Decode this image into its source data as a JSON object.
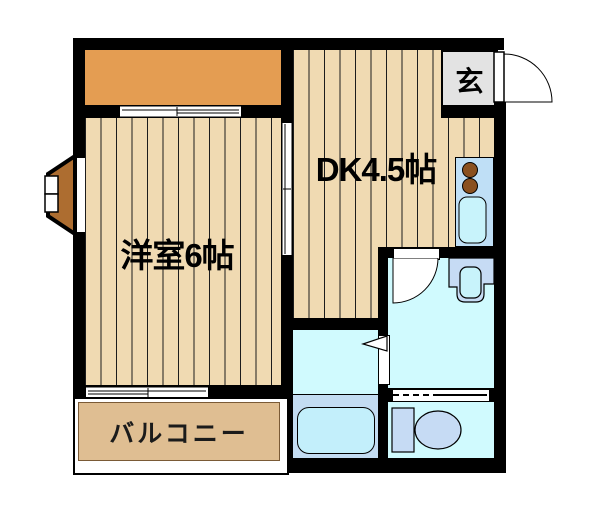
{
  "floorplan": {
    "labels": {
      "dining_kitchen": "DK4.5帖",
      "western_room": "洋室6帖",
      "entrance": "玄",
      "balcony": "バルコニー"
    },
    "colors": {
      "wall": "#000000",
      "floor": "#F0DAB2",
      "floor_line": "#1c1c1c",
      "closet": "#E49D52",
      "balcony": "#DFBE92",
      "balcony_edge": "#7a5a36",
      "bay_window": "#AD6D30",
      "entrance_floor": "#E3E3E3",
      "water_floor": "#D0FAFE",
      "bath_floor": "#C3DCF2",
      "bathtub": "#C3EFFB",
      "fixture_blue": "#C6DBF4",
      "kitchen_unit": "#BFDFF6",
      "kitchen_sink": "#C8F3FB",
      "burner": "#8A501F",
      "door_white": "#FFFFFF"
    },
    "fixtures": {
      "kitchen": "kitchen-unit-with-two-burner-stove-and-sink",
      "washbasin": "washbasin",
      "bathtub": "bathtub",
      "toilet": "toilet",
      "entrance_door": "hinged-door-outswing",
      "washroom_door": "hinged-door-inswing",
      "bath_door": "folding-door",
      "partition": "accordion-partition",
      "closet_door": "sliding-door",
      "room_divider_door": "sliding-door",
      "balcony_window": "sliding-window",
      "bay_window": "bay-window"
    }
  }
}
